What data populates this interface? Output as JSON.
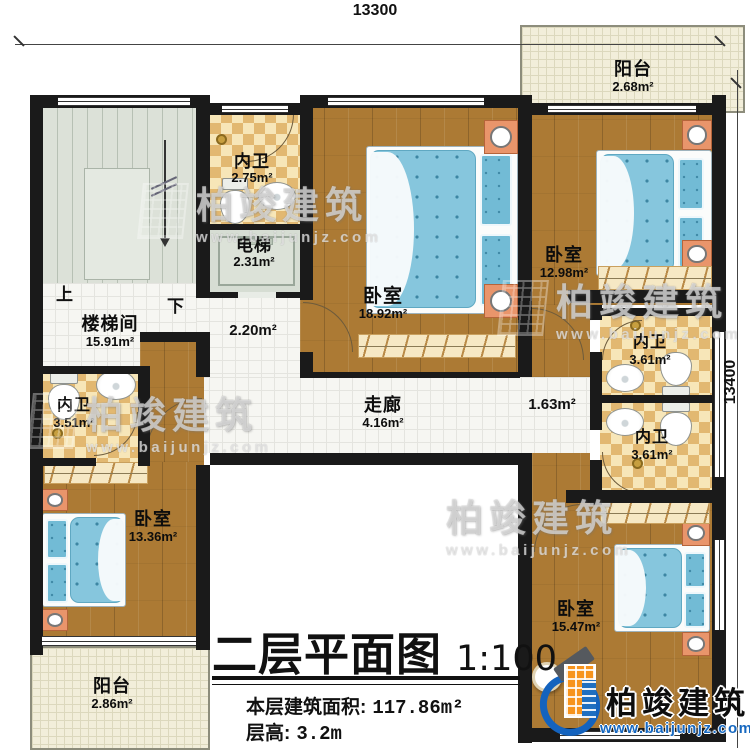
{
  "title": {
    "main": "二层平面图",
    "scale": "1:100"
  },
  "info": {
    "area_label": "本层建筑面积:",
    "area_value": "117.86m²",
    "height_label": "层高:",
    "height_value": "3.2m"
  },
  "dimensions": {
    "top": "13300",
    "right": "13400"
  },
  "rooms": {
    "balcony_tr": {
      "label": "阳台",
      "area": "2.68m²"
    },
    "bath_tl": {
      "label": "内卫",
      "area": "2.75m²"
    },
    "elevator": {
      "label": "电梯",
      "area": "2.31m²"
    },
    "stairwell": {
      "label": "楼梯间",
      "area": "15.91m²"
    },
    "bedroom_center": {
      "label": "卧室",
      "area": "18.92m²"
    },
    "bedroom_tr": {
      "label": "卧室",
      "area": "12.98m²"
    },
    "bath_r1": {
      "label": "内卫",
      "area": "3.61m²"
    },
    "bath_r2": {
      "label": "内卫",
      "area": "3.61m²"
    },
    "bath_l": {
      "label": "内卫",
      "area": "3.51m²"
    },
    "bedroom_l": {
      "label": "卧室",
      "area": "13.36m²"
    },
    "corridor": {
      "label": "走廊",
      "area": "4.16m²"
    },
    "bedroom_br": {
      "label": "卧室",
      "area": "15.47m²"
    },
    "balcony_bl": {
      "label": "阳台",
      "area": "2.86m²"
    },
    "hall": {
      "area": "2.20m²"
    },
    "vestibule": {
      "area": "1.63m²"
    }
  },
  "stairs": {
    "up": "上",
    "down": "下"
  },
  "watermark": {
    "name": "柏竣建筑",
    "site": "www.baijunjz.com"
  },
  "logo": {
    "name": "柏竣建筑",
    "site": "www.baijunjz.com"
  }
}
